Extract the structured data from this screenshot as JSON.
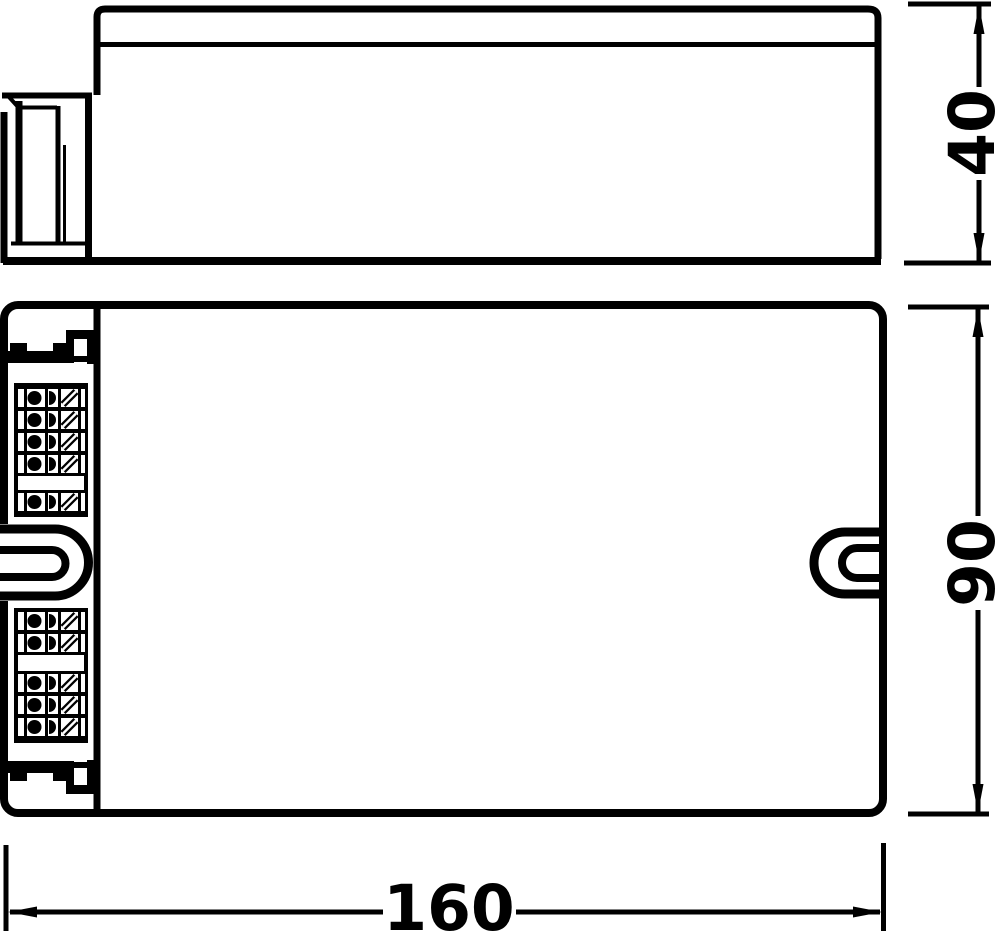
{
  "drawing": {
    "kind": "technical-dimension-drawing",
    "colors": {
      "line": "#000000",
      "background": "#ffffff"
    }
  },
  "dimensions": {
    "height": "40",
    "depth": "90",
    "length": "160"
  }
}
